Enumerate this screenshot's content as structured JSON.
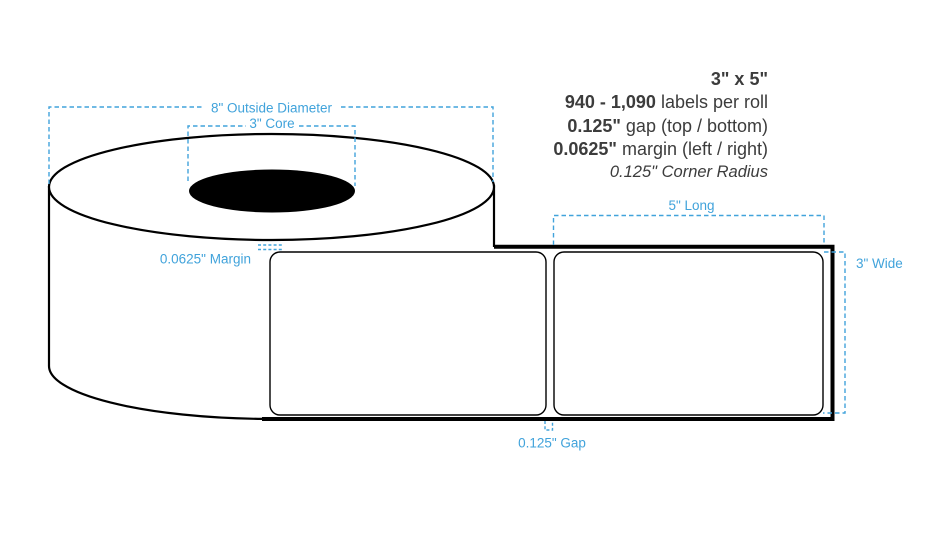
{
  "specs": {
    "size": "3\" x 5\"",
    "count_value": "940 - 1,090",
    "count_label": " labels per roll",
    "gap_value": "0.125\"",
    "gap_label": " gap (top / bottom)",
    "margin_value": "0.0625\"",
    "margin_label": " margin (left / right)",
    "corner_radius": "0.125\" Corner Radius"
  },
  "dimensions": {
    "outside_diameter": "8\" Outside Diameter",
    "core": "3\" Core",
    "margin": "0.0625\" Margin",
    "length": "5\" Long",
    "width": "3\" Wide",
    "gap": "0.125\" Gap"
  },
  "colors": {
    "dimension_blue": "#41a3db",
    "spec_text": "#3c3c3c",
    "outline": "#000000"
  }
}
